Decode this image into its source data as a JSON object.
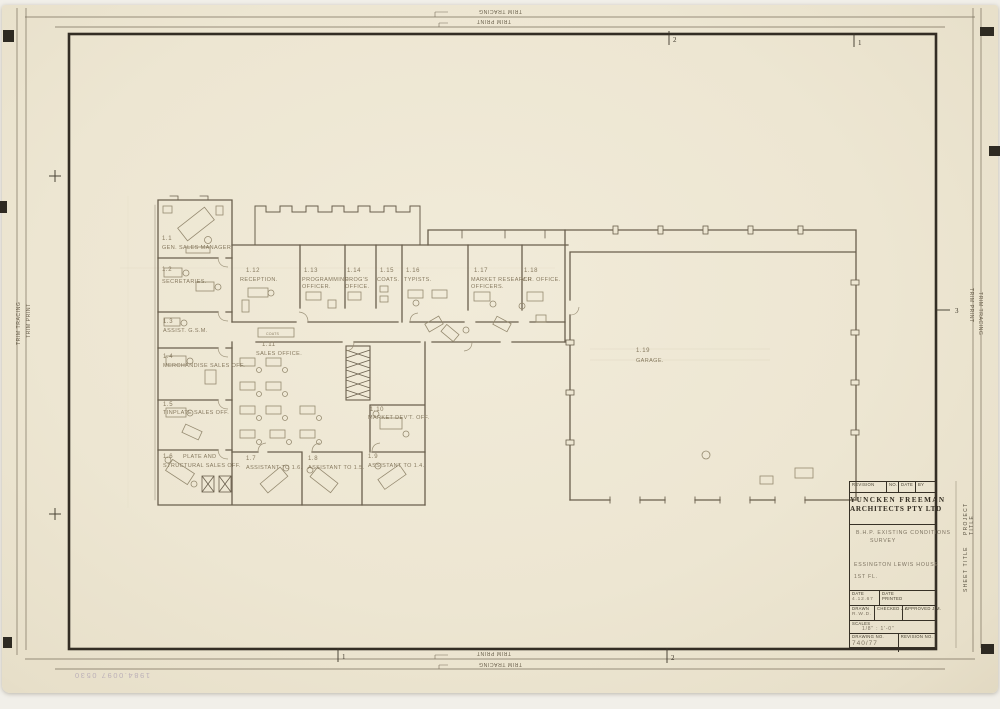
{
  "document": {
    "type": "architectural floor plan drawing, scanned tracing sheet"
  },
  "trim_labels": {
    "top_tracing": "TRIM TRACING",
    "top_print": "TRIM PRINT",
    "bottom_print": "TRIM PRINT",
    "bottom_tracing": "TRIM TRACING",
    "left_tracing": "TRIM TRACING",
    "left_print": "TRIM PRINT",
    "right_print": "TRIM PRINT",
    "right_tracing": "TRIM TRACING"
  },
  "fold_marks": {
    "top_center": "2",
    "top_right": "1",
    "bottom_left": "1",
    "bottom_center": "2",
    "right_middle": "3"
  },
  "rooms": [
    {
      "number": "1.1",
      "name": "GEN. SALES MANAGER."
    },
    {
      "number": "1.2",
      "name": "SECRETARIES."
    },
    {
      "number": "1.3",
      "name": "ASSIST. G.S.M."
    },
    {
      "number": "1.4",
      "name": "MERCHANDISE SALES OFF."
    },
    {
      "number": "1.5",
      "name": "TINPLATE SALES OFF."
    },
    {
      "number": "1.6",
      "name": "PLATE AND",
      "name2": "STRUCTURAL SALES OFF."
    },
    {
      "number": "1.7",
      "name": "ASSISTANT TO 1.6."
    },
    {
      "number": "1.8",
      "name": "ASSISTANT TO 1.5."
    },
    {
      "number": "1.9",
      "name": "ASSISTANT TO 1.4."
    },
    {
      "number": "1.10",
      "name": "MARKET DEV'T. OFF."
    },
    {
      "number": "1.11",
      "name": "SALES OFFICE."
    },
    {
      "number": "1.12",
      "name": "RECEPTION."
    },
    {
      "number": "1.13",
      "name": "PROGRAMMING",
      "name2": "OFFICER."
    },
    {
      "number": "1.14",
      "name": "PROG'S",
      "name2": "OFFICE."
    },
    {
      "number": "1.15",
      "name": "COATS."
    },
    {
      "number": "1.16",
      "name": "TYPISTS."
    },
    {
      "number": "1.17",
      "name": "MARKET RESEARCH",
      "name2": "OFFICERS."
    },
    {
      "number": "1.18",
      "name": "M.R. OFFICE."
    },
    {
      "number": "1.19",
      "name": "GARAGE."
    }
  ],
  "plan_annotations": {
    "corridor_cabinet": "COATS"
  },
  "title_block": {
    "revision_row": {
      "revision": "REVISION",
      "no": "NO.",
      "date": "DATE",
      "by": "BY"
    },
    "firm": {
      "line1": "YUNCKEN FREEMAN",
      "line2": "ARCHITECTS PTY LTD"
    },
    "project_title_line1": "B.H.P. EXISTING CONDITIONS",
    "project_title_line2": "SURVEY",
    "sheet_title_line1": "ESSINGTON LEWIS HOUSE",
    "sheet_title_line2": "1ST FL.",
    "fields": {
      "date_label": "DATE",
      "date_value": "4.12.67",
      "date_printed_label": "DATE PRINTED",
      "drawn_label": "DRAWN",
      "drawn_value": "R.W.D.",
      "checked_label": "CHECKED J.C.",
      "approved_label": "APPROVED J.M.",
      "scales_label": "SCALES",
      "scales_value": "1/8\" : 1'-0\"",
      "drawing_no_label": "DRAWING NO.",
      "drawing_no_value": "740/77",
      "revision_no_label": "REVISION NO."
    },
    "side_labels": {
      "project": "PROJECT TITLE",
      "sheet": "SHEET TITLE"
    }
  },
  "annotations": {
    "accession_number": "1984.0097 0530"
  },
  "colors": {
    "paper": "#ece5d1",
    "frame": "#332d24",
    "pencil_wall": "#6a5f4d",
    "pencil_light": "#958a70",
    "pencil_text": "#86795f",
    "print_text": "#474131",
    "handwriting": "#7c7260",
    "stamp": "#a89bb0"
  }
}
